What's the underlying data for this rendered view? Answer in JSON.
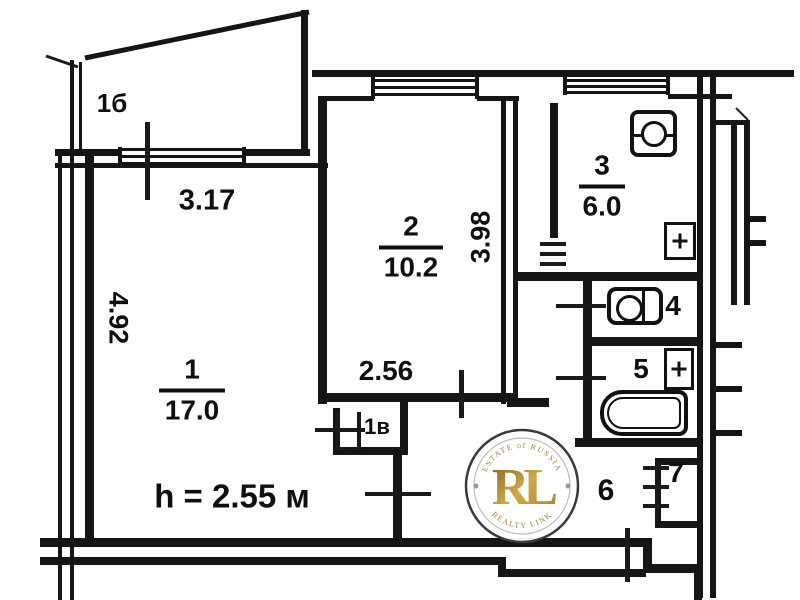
{
  "plan": {
    "rooms": {
      "r1": {
        "number": "1",
        "area": "17.0"
      },
      "r2": {
        "number": "2",
        "area": "10.2"
      },
      "r3": {
        "number": "3",
        "area": "6.0"
      },
      "r4": {
        "number": "4"
      },
      "r5": {
        "number": "5"
      },
      "r6": {
        "number": "6"
      },
      "r7": {
        "number": "7"
      },
      "closet": {
        "number": "1в"
      },
      "balcony": {
        "number": "1б"
      }
    },
    "dimensions": {
      "balcony_width": "3.17",
      "room1_depth": "4.92",
      "room2_width": "2.56",
      "room2_depth": "3.98"
    },
    "ceiling_height_note": "h = 2.55 м",
    "watermark": {
      "initials": "RL",
      "arc_top": "ESTATE of RUSSIA",
      "arc_bottom": "REALTY LINK",
      "gold": "#b08c3d"
    }
  }
}
